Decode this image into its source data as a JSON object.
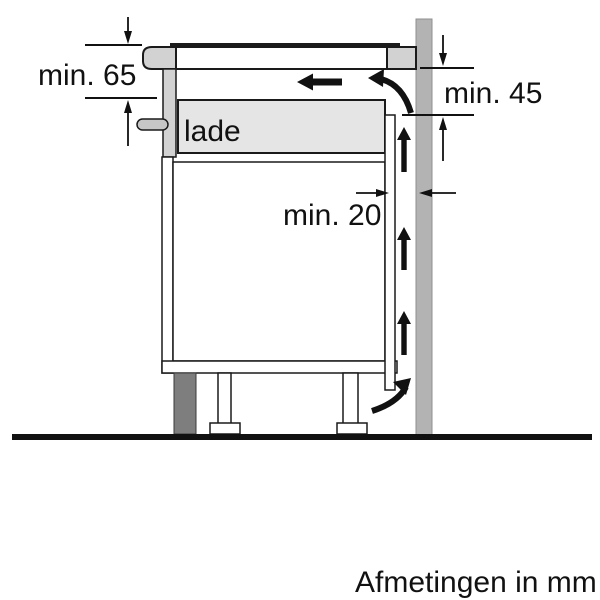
{
  "diagram": {
    "caption": "Afmetingen in mm",
    "drawer_label": "lade",
    "dimensions": {
      "hob_depth": {
        "label": "min. 65"
      },
      "wall_side": {
        "label": "min. 45"
      },
      "rear_gap": {
        "label": "min. 20"
      }
    },
    "icons": {
      "airflow-up-arrow": "▲",
      "airflow-left-arrow": "◀",
      "airflow-curve-arrow": "↗",
      "dimension-arrow": "▾"
    },
    "colors": {
      "outline": "#1a1a1a",
      "wall": "#b3b3b3",
      "wall_edge": "#8f8f8f",
      "worktop": "#d2d2d2",
      "hob_glass": "#1c1c1c",
      "cabinet_fill": "#ffffff",
      "drawer": "#e5e5e5",
      "handle": "#c6c6c6",
      "plinth": "#7e7e7e",
      "floor": "#111111",
      "arrow": "#111111",
      "text": "#111111"
    }
  }
}
